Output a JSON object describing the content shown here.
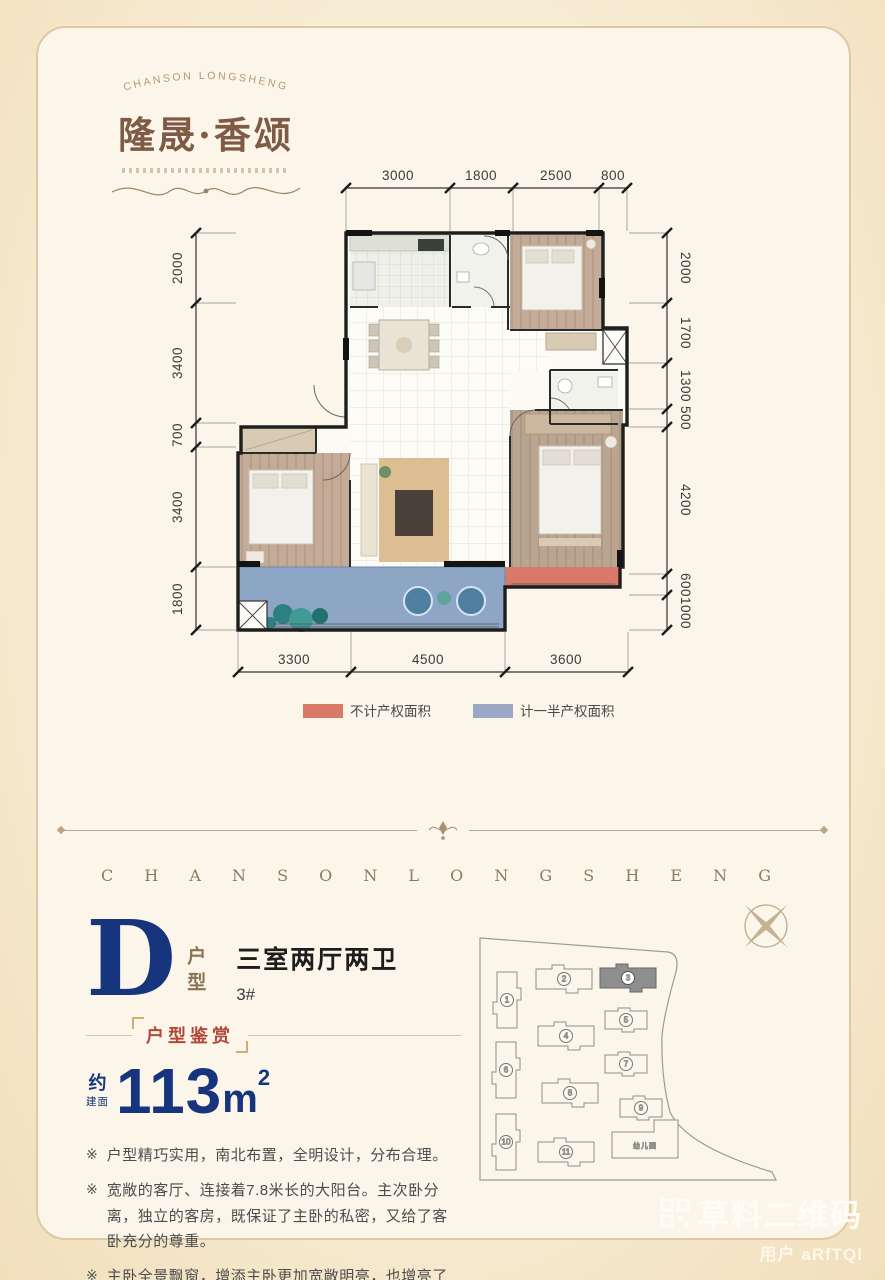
{
  "logo": {
    "brand_arc": "CHANSON LONGSHENG",
    "brand_cn": "隆晟·香颂"
  },
  "floorplan": {
    "dims_top": [
      "3000",
      "1800",
      "2500",
      "800"
    ],
    "dims_left": [
      "2000",
      "3400",
      "700",
      "3400",
      "1800"
    ],
    "dims_right": [
      "2000",
      "1700",
      "1300",
      "500",
      "4200",
      "600",
      "1000"
    ],
    "dims_bottom": [
      "3300",
      "4500",
      "3600"
    ],
    "legend": [
      {
        "label": "不计产权面积",
        "color": "#d9796a"
      },
      {
        "label": "计一半产权面积",
        "color": "#9aa8c6"
      }
    ]
  },
  "divider": {
    "brand_spaced": "C H A N S O N L O N G S H E N G"
  },
  "unit": {
    "type_letter": "D",
    "type_label": "户型",
    "layout_name": "三室两厅两卫",
    "building_no": "3#",
    "section_label": "户型鉴赏",
    "area_approx": "约",
    "area_prefix": "建面",
    "area_value": "113",
    "area_unit": "m",
    "area_sup": "2",
    "bullet_marker": "※",
    "features": [
      "户型精巧实用，南北布置，全明设计，分布合理。",
      "宽敞的客厅、连接着7.8米长的大阳台。主次卧分离，独立的客房，既保证了主卧的私密，又给了客卧充分的尊重。",
      "主卧全景飘窗，增添主卧更加宽敞明亮，也增亮了丰富多彩的人生。"
    ]
  },
  "siteplan": {
    "buildings": [
      "1",
      "2",
      "3",
      "4",
      "5",
      "6",
      "7",
      "8",
      "9",
      "10",
      "11"
    ],
    "kindergarten": "幼儿园"
  },
  "watermark": {
    "line1": "草料二维码",
    "line2": "用户 aRfTQl"
  }
}
